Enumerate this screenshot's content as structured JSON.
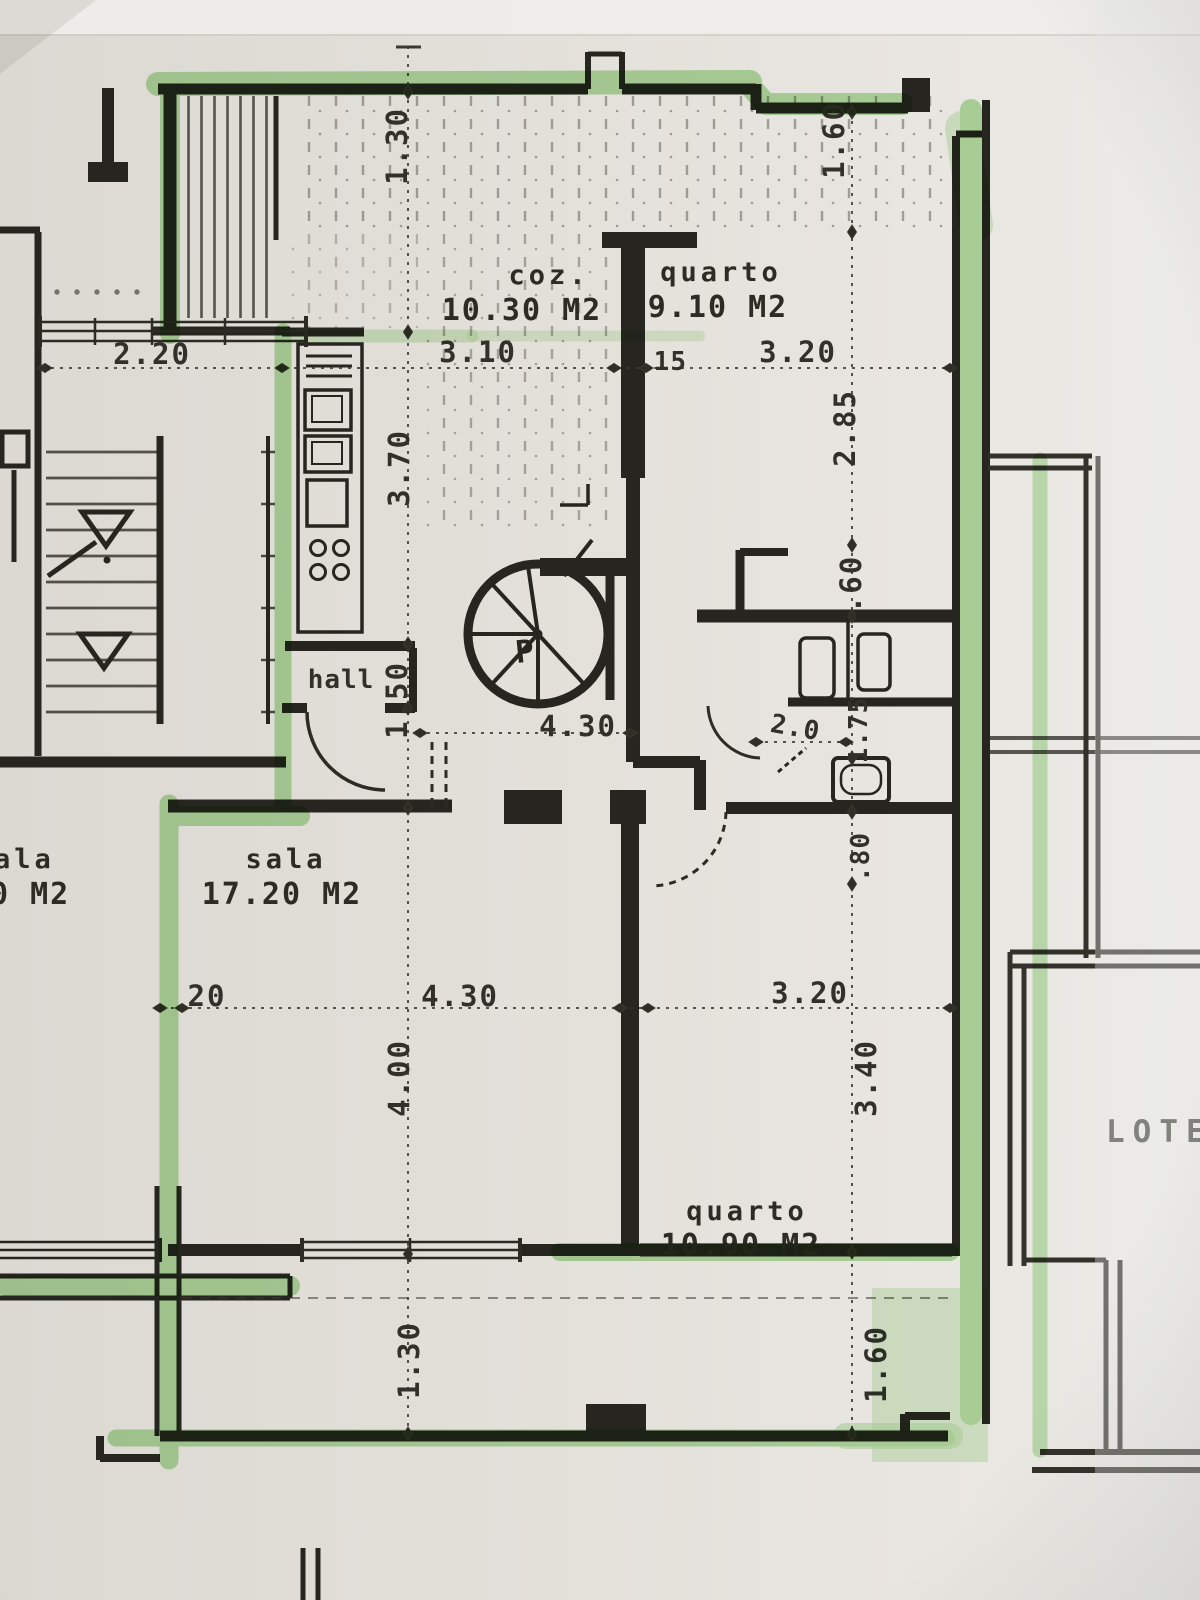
{
  "plan_labels": {
    "kitchen_name": "coz.",
    "kitchen_area": "10.30 M2",
    "bedroom1_name": "quarto",
    "bedroom1_area": "9.10 M2",
    "living_name": "sala",
    "living_area": "17.20 M2",
    "bedroom2_name": "quarto",
    "bedroom2_area": "10.90 M2",
    "hall_name": "hall",
    "left_unit_room_partial": "ala",
    "left_unit_area_partial": "0 M2",
    "stair_mark": "P",
    "lot_label": "LOTE"
  },
  "dimensions": {
    "balcony_top_depth": "1.30",
    "balcony_top_right_depth": "1.60",
    "left_room_width": "2.20",
    "kitchen_width": "3.10",
    "wall_thickness": ".15",
    "bedroom1_width": "3.20",
    "kitchen_length": "3.70",
    "bedroom1_length": "2.85",
    "closet_depth": ".60",
    "hall_depth": "1.50",
    "hall_span": "4.30",
    "bath_width": "2.0",
    "bath_length": "1.75",
    "door_width": ".80",
    "wall_offset": "20",
    "living_width": "4.30",
    "living_length": "4.00",
    "bedroom2_width": "3.20",
    "bedroom2_length": "3.40",
    "balcony_bottom_depth": "1.30",
    "balcony_bottom_right_depth": "1.60"
  },
  "colors": {
    "highlighter_green": "#7cc960",
    "ink": "#26251f",
    "paper": "#e3e0da"
  }
}
